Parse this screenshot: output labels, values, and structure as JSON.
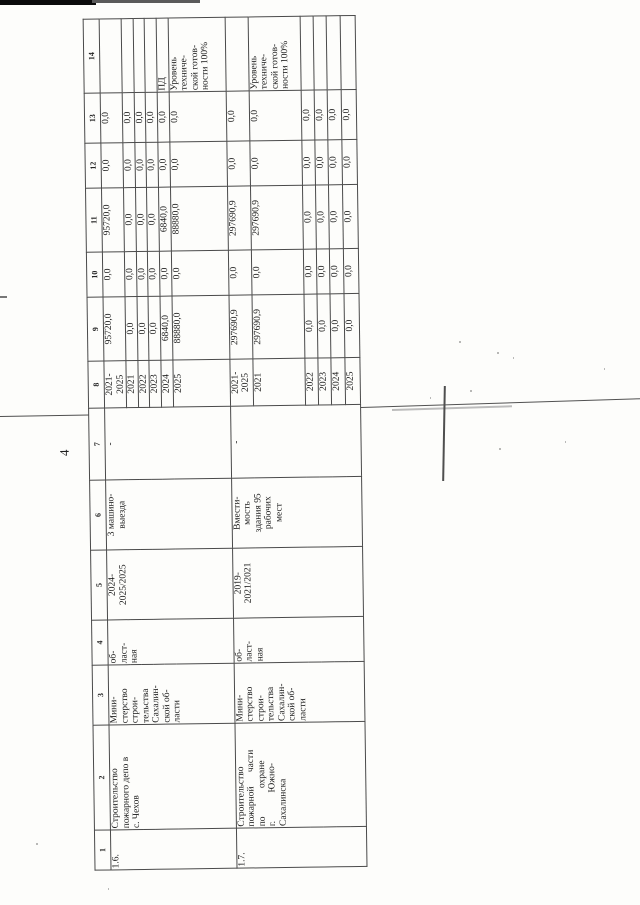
{
  "page": {
    "number": "4"
  },
  "table": {
    "column_numbers": [
      "1",
      "2",
      "3",
      "4",
      "5",
      "6",
      "7",
      "8",
      "9",
      "10",
      "11",
      "12",
      "13",
      "14"
    ],
    "rows": [
      {
        "num": "1.6.",
        "name": "Строительство\nпожарного депо в\nс. Чехов",
        "executor": "Мини-\nстерство\nстрои-\nтельства\nСахалин-\nской об-\nласти",
        "ownership": "об-\nласт-\nная",
        "period": "2024-\n2025/2025",
        "capacity": "3 машино-\nвыезда",
        "col7": "-",
        "periods": [
          {
            "year": "2021-\n2025",
            "c9": "95720,0",
            "c10": "0,0",
            "c11": "95720,0",
            "c12": "0,0",
            "c13": "0,0",
            "c14": ""
          },
          {
            "year": "2021",
            "c9": "0,0",
            "c10": "0,0",
            "c11": "0,0",
            "c12": "0,0",
            "c13": "0,0",
            "c14": ""
          },
          {
            "year": "2022",
            "c9": "0,0",
            "c10": "0,0",
            "c11": "0,0",
            "c12": "0,0",
            "c13": "0,0",
            "c14": ""
          },
          {
            "year": "2023",
            "c9": "0,0",
            "c10": "0,0",
            "c11": "0,0",
            "c12": "0,0",
            "c13": "0,0",
            "c14": ""
          },
          {
            "year": "2024",
            "c9": "6840,0",
            "c10": "0,0",
            "c11": "6840,0",
            "c12": "0,0",
            "c13": "0,0",
            "c14": "ПД"
          },
          {
            "year": "2025",
            "c9": "88880,0",
            "c10": "0,0",
            "c11": "88880,0",
            "c12": "0,0",
            "c13": "0,0",
            "c14": "Уровень\nтехниче-\nской готов-\nности 100%"
          }
        ]
      },
      {
        "num": "1.7.",
        "name": "Строительство\nпожарной      части\nпо            охране\nг.            Южно-\nСахалинска",
        "executor": "Мини-\nстерство\nстрои-\nтельства\nСахалин-\nской об-\nласти",
        "ownership": "об-\nласт-\nная",
        "period": "2019-\n2021/2021",
        "capacity": "Вмести-\nмость\nздания 95\nрабочих\nмест",
        "col7": "-",
        "periods": [
          {
            "year": "2021-\n2025",
            "c9": "297690,9",
            "c10": "0,0",
            "c11": "297690,9",
            "c12": "0,0",
            "c13": "0,0",
            "c14": ""
          },
          {
            "year": "2021",
            "c9": "297690,9",
            "c10": "0,0",
            "c11": "297690,9",
            "c12": "0,0",
            "c13": "0,0",
            "c14": "Уровень\nтехниче-\nской готов-\nности 100%"
          },
          {
            "year": "2022",
            "c9": "0,0",
            "c10": "0,0",
            "c11": "0,0",
            "c12": "0,0",
            "c13": "0,0",
            "c14": ""
          },
          {
            "year": "2023",
            "c9": "0,0",
            "c10": "0,0",
            "c11": "0,0",
            "c12": "0,0",
            "c13": "0,0",
            "c14": ""
          },
          {
            "year": "2024",
            "c9": "0,0",
            "c10": "0,0",
            "c11": "0,0",
            "c12": "0,0",
            "c13": "0,0",
            "c14": ""
          },
          {
            "year": "2025",
            "c9": "0,0",
            "c10": "0,0",
            "c11": "0,0",
            "c12": "0,0",
            "c13": "0,0",
            "c14": ""
          }
        ]
      }
    ]
  }
}
